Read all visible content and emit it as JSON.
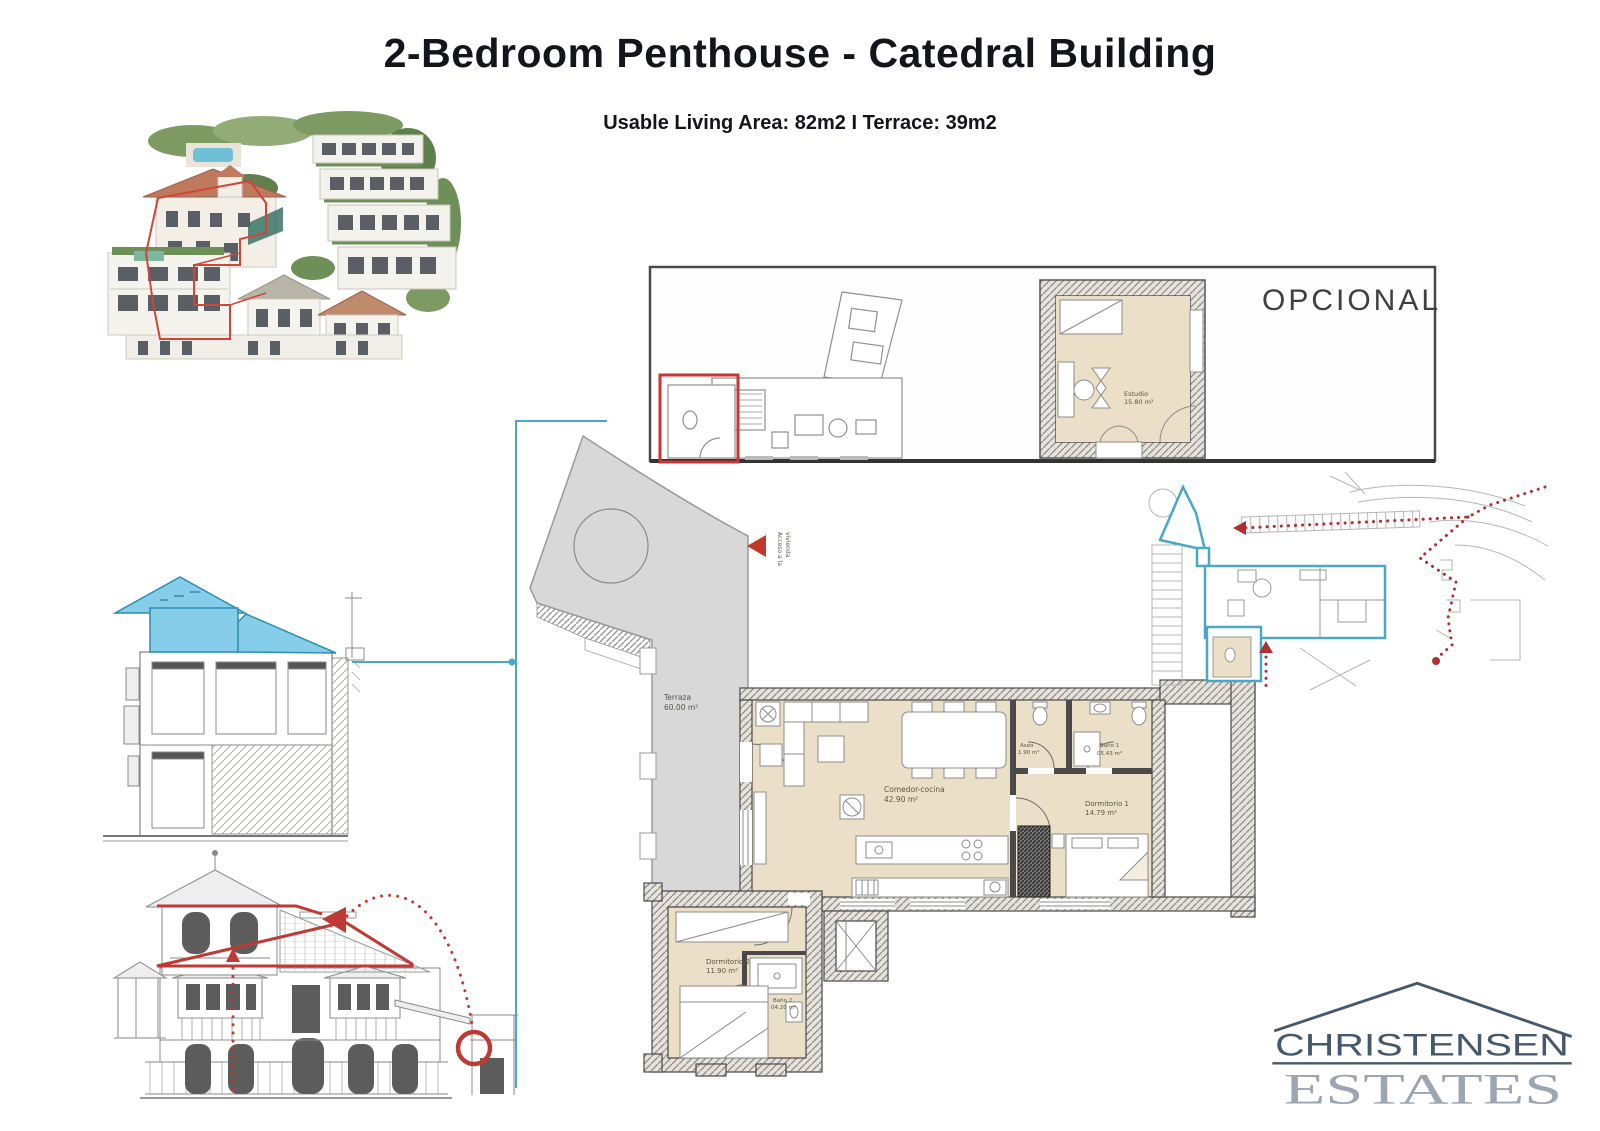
{
  "header": {
    "title": "2-Bedroom Penthouse - Catedral Building",
    "subtitle": "Usable Living Area: 82m2 I Terrace: 39m2"
  },
  "optional_plan": {
    "title": "OPCIONAL",
    "room": {
      "name": "Estudio",
      "area": "15.80 m²"
    }
  },
  "main_plan": {
    "terrace": {
      "name": "Terraza",
      "area": "60.00 m²"
    },
    "access_label_line1": "Acceso a la",
    "access_label_line2": "vivienda",
    "rooms": [
      {
        "name": "Comedor-cocina",
        "area": "42.90 m²"
      },
      {
        "name": "Aseo",
        "area": "1.90 m²"
      },
      {
        "name": "Baño 1",
        "area": "05.43 m²"
      },
      {
        "name": "Dormitorio 1",
        "area": "14.79 m²"
      },
      {
        "name": "Dormitorio 2",
        "area": "11.90 m²"
      },
      {
        "name": "Baño 2",
        "area": "04.20 m²"
      }
    ]
  },
  "logo": {
    "name": "CHRISTENSEN",
    "type": "ESTATES"
  },
  "colors": {
    "accent_blue": "#49a8c6",
    "accent_red": "#c0392b",
    "room_fill": "#ecdfc8",
    "terrace_fill": "#d8d8d8",
    "wall_grey": "#8c887f",
    "logo_dark": "#46586b",
    "logo_light": "#9ba6b2"
  }
}
